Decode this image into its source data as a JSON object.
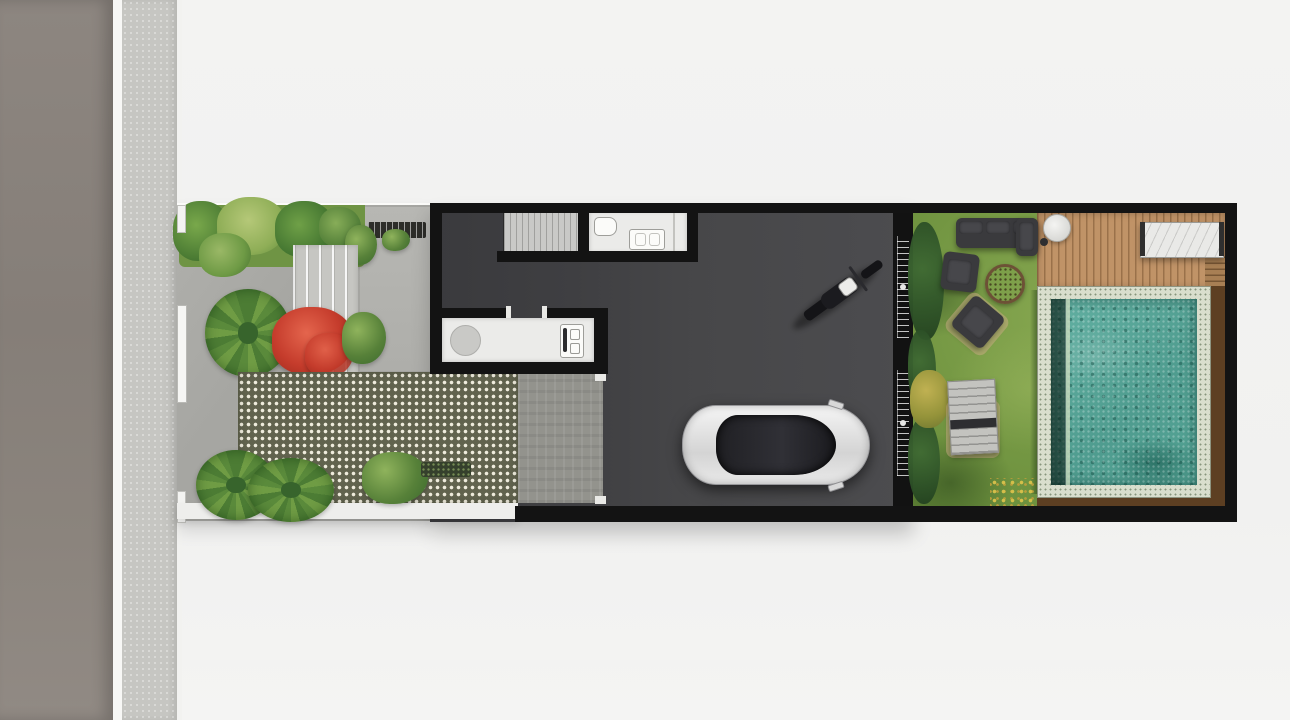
{
  "scene": {
    "type": "architectural site plan, top-down 3D render, no visible text",
    "regions": {
      "street": {
        "name": "asphalt street strip",
        "color": "#8a837d"
      },
      "sidewalk": {
        "name": "textured sidewalk strip",
        "color": "#c6c6c2"
      },
      "front_garden": {
        "name": "front garden court with planting bed, steps, red shrub and palms",
        "paving_color": "#a6a6a2"
      },
      "carport": {
        "name": "carport with grass-block checker pavers",
        "color": "#61634e"
      },
      "interior": {
        "name": "interior floor with staircase, bathroom and kitchen counter",
        "floor_color": "#3f3f42"
      },
      "garage": {
        "name": "garage bay with car and motorcycle",
        "floor_color": "#4b4b4e"
      },
      "backyard": {
        "name": "backyard lawn with outdoor furniture",
        "lawn_color": "#6d913e"
      },
      "deck": {
        "name": "timber pool deck",
        "color": "#c09367"
      },
      "pool": {
        "name": "mosaic swimming pool",
        "water_color": "#55a596",
        "coping_color": "#d9decd"
      },
      "pool_surround": {
        "name": "dark timber pool surround",
        "color": "#5d3f22"
      }
    },
    "objects": [
      {
        "name": "white-sedan-car"
      },
      {
        "name": "black-motorcycle"
      },
      {
        "name": "staircase"
      },
      {
        "name": "bathroom-toilet"
      },
      {
        "name": "bathroom-vanity"
      },
      {
        "name": "kitchen-round-table"
      },
      {
        "name": "kitchen-stove"
      },
      {
        "name": "sliding-glass-doors"
      },
      {
        "name": "outdoor-sofa"
      },
      {
        "name": "outdoor-armchair"
      },
      {
        "name": "fire-pit"
      },
      {
        "name": "rotated-lounge-chair"
      },
      {
        "name": "sun-lounger"
      },
      {
        "name": "round-side-table"
      },
      {
        "name": "marble-dining-table"
      },
      {
        "name": "red-flowering-shrub"
      },
      {
        "name": "palm-plants"
      },
      {
        "name": "yellow-flower-patch"
      }
    ],
    "palette": {
      "background": "#f2f2f1",
      "wall_black": "#131313",
      "room_white": "#ebebe9",
      "steps_gray": "#c6c6c2",
      "red_shrub": "#c53c2c",
      "green_plant": "#578139",
      "checker_base": "#61634e",
      "teal_water": "#55a596",
      "deck_tan": "#c09367",
      "brown_surround": "#5d3f22"
    }
  }
}
